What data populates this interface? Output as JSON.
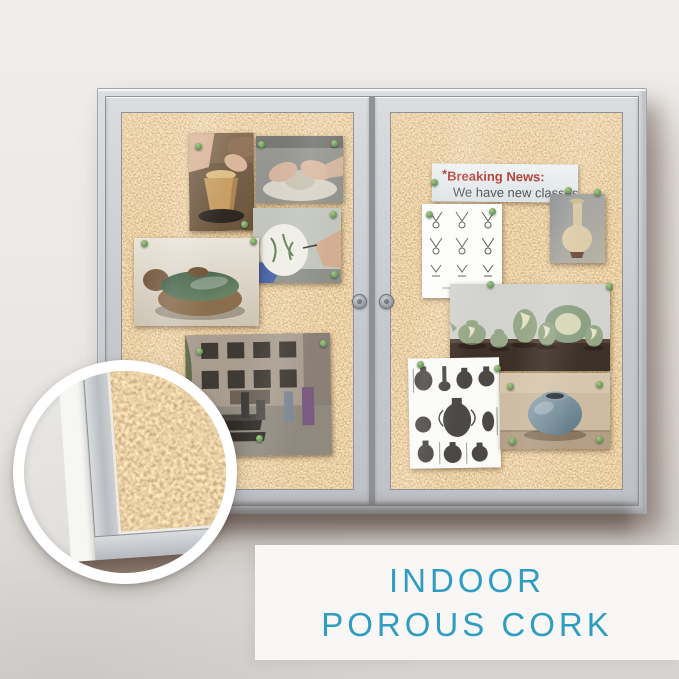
{
  "caption": {
    "line1": "INDOOR",
    "line2": "POROUS CORK",
    "color": "#2F9DC2",
    "background": "#F8F7F5"
  },
  "board": {
    "news_card": {
      "prefix": "*",
      "title": "Breaking News:",
      "subtitle": "We have new classes",
      "title_color": "#B23A30",
      "subtitle_color": "#4F4F4D"
    },
    "cork_color": "#C89B60",
    "frame_color": "#C9CCD1",
    "pin_color": "#6F9B5C",
    "wall_color": "#ECEAE7",
    "doors": 2,
    "pinned_items": {
      "left_door": [
        {
          "name": "photo-pot-trimming",
          "alt": "hands shaping an upturned clay pot on a wheel"
        },
        {
          "name": "photo-hands-on-wheel",
          "alt": "hands forming clay on a pottery wheel"
        },
        {
          "name": "photo-vase-painting",
          "alt": "brush painting a leafy pattern on a white vase"
        },
        {
          "name": "photo-lidded-dish",
          "alt": "green lidded ceramic dish"
        },
        {
          "name": "photo-courtyard",
          "alt": "people in a brick courtyard workshop"
        }
      ],
      "right_door": [
        {
          "name": "news-card",
          "alt": "breaking news notice card"
        },
        {
          "name": "sketch-sheet-profiles",
          "alt": "sheet of pottery profile sketches"
        },
        {
          "name": "photo-cream-vase",
          "alt": "cream colored vase"
        },
        {
          "name": "photo-green-pottery",
          "alt": "green glazed pottery set on a wooden table"
        },
        {
          "name": "sketch-sheet-amphorae",
          "alt": "sheet of amphora drawings with measurements"
        },
        {
          "name": "photo-blue-pot",
          "alt": "blue glazed round pot"
        }
      ]
    }
  },
  "icons": {
    "push-pin-icon": "small green round push pin",
    "lock-icon": "round silver cam lock on each door",
    "magnifier-circle": "white-ringed circular zoom detail of the porous cork surface"
  }
}
